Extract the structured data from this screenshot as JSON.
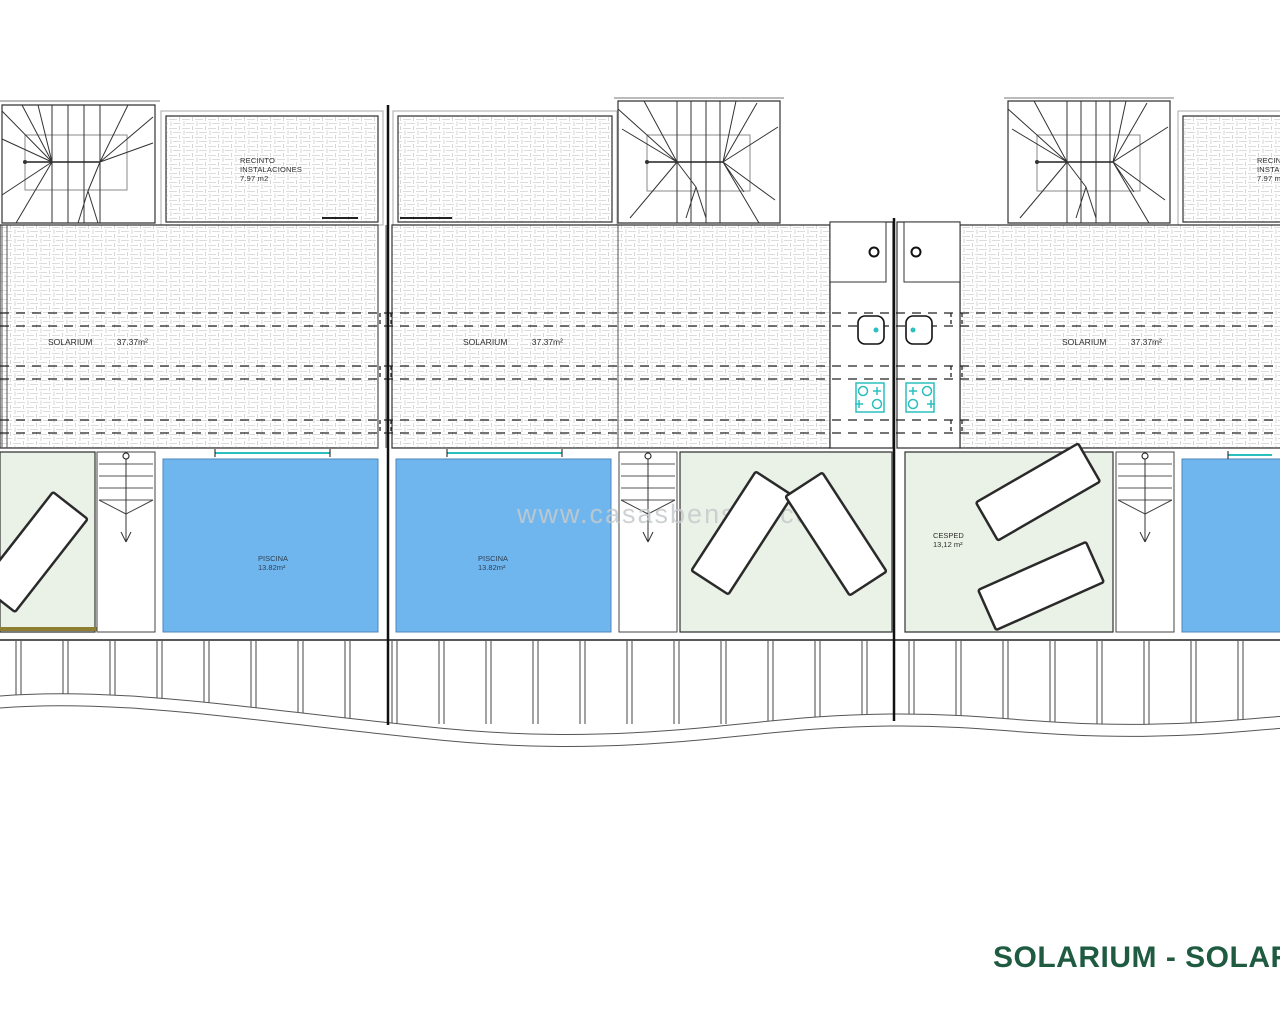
{
  "plan_title": {
    "text": "SOLARIUM - SOLARIUM",
    "color": "#1E5B41"
  },
  "watermark": {
    "text": "www.casasbenson.com"
  },
  "labels": {
    "recinto": {
      "line1": "RECINTO",
      "line2": "INSTALACIONES",
      "area": "7.97 m2"
    },
    "solarium": {
      "name": "SOLARIUM",
      "area": "37.37m²"
    },
    "piscina": {
      "name": "PISCINA",
      "area": "13.82m²"
    },
    "cesped": {
      "name": "CESPED",
      "area": "13,12 m²"
    }
  },
  "colors": {
    "pool_fill": "#70B6EE",
    "grass_fill": "#EAF1E7",
    "fixture_teal": "#2BBFBF",
    "hatch_gray": "#DCDCDC",
    "title_green": "#1E5B41",
    "watermark_gray": "#C6CACC",
    "lawn_strip_olive": "#8F7F33"
  }
}
